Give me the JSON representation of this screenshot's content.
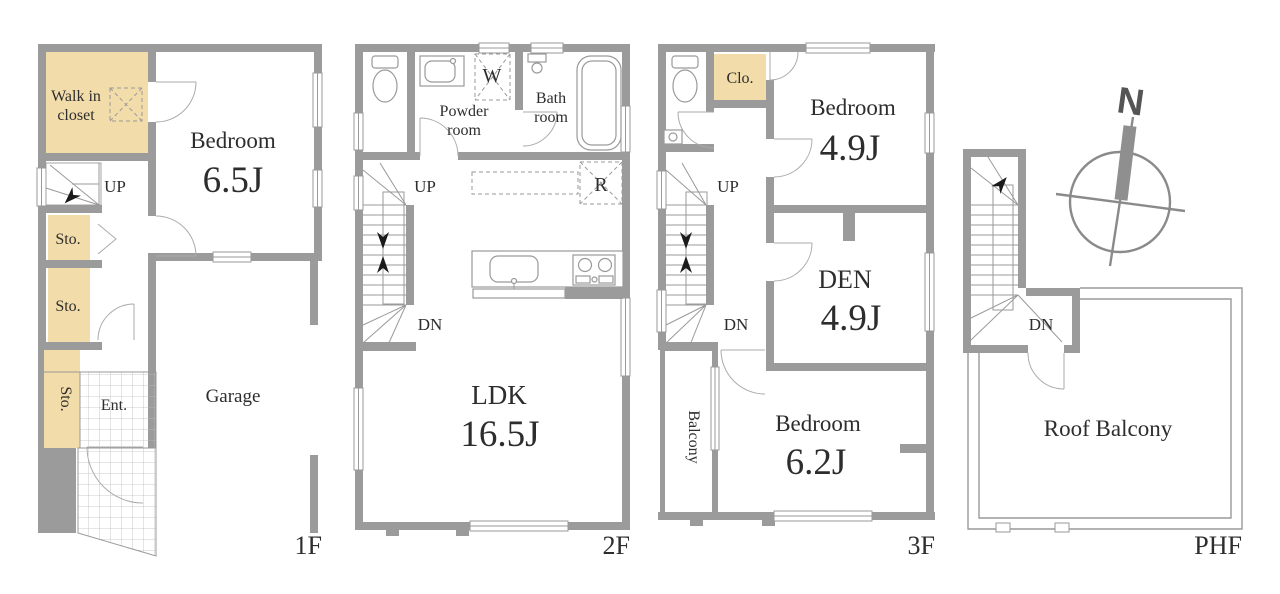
{
  "meta": {
    "type": "residential floor plan, 4 levels",
    "wall_color": "#9b9b9b",
    "closet_color": "#f2dcaa",
    "text_color": "#2d2d2d"
  },
  "floors": [
    {
      "label": "1F",
      "walk_in_closet": [
        "Walk in",
        "closet"
      ],
      "bedroom": "Bedroom",
      "bedroom_size": "6.5J",
      "up": "UP",
      "sto_labels": [
        "Sto.",
        "Sto.",
        "Sto."
      ],
      "ent": "Ent.",
      "garage": "Garage"
    },
    {
      "label": "2F",
      "powder_room": [
        "Powder",
        "room"
      ],
      "washer": "W",
      "bath_room": [
        "Bath",
        "room"
      ],
      "up": "UP",
      "dn": "DN",
      "fridge": "R",
      "ldk": "LDK",
      "ldk_size": "16.5J"
    },
    {
      "label": "3F",
      "closet": "Clo.",
      "bedroom1": "Bedroom",
      "bedroom1_size": "4.9J",
      "up": "UP",
      "dn": "DN",
      "den": "DEN",
      "den_size": "4.9J",
      "balcony": "Balcony",
      "bedroom2": "Bedroom",
      "bedroom2_size": "6.2J"
    },
    {
      "label": "PHF",
      "dn": "DN",
      "roof_balcony": "Roof Balcony"
    }
  ],
  "compass": {
    "north": "N"
  }
}
